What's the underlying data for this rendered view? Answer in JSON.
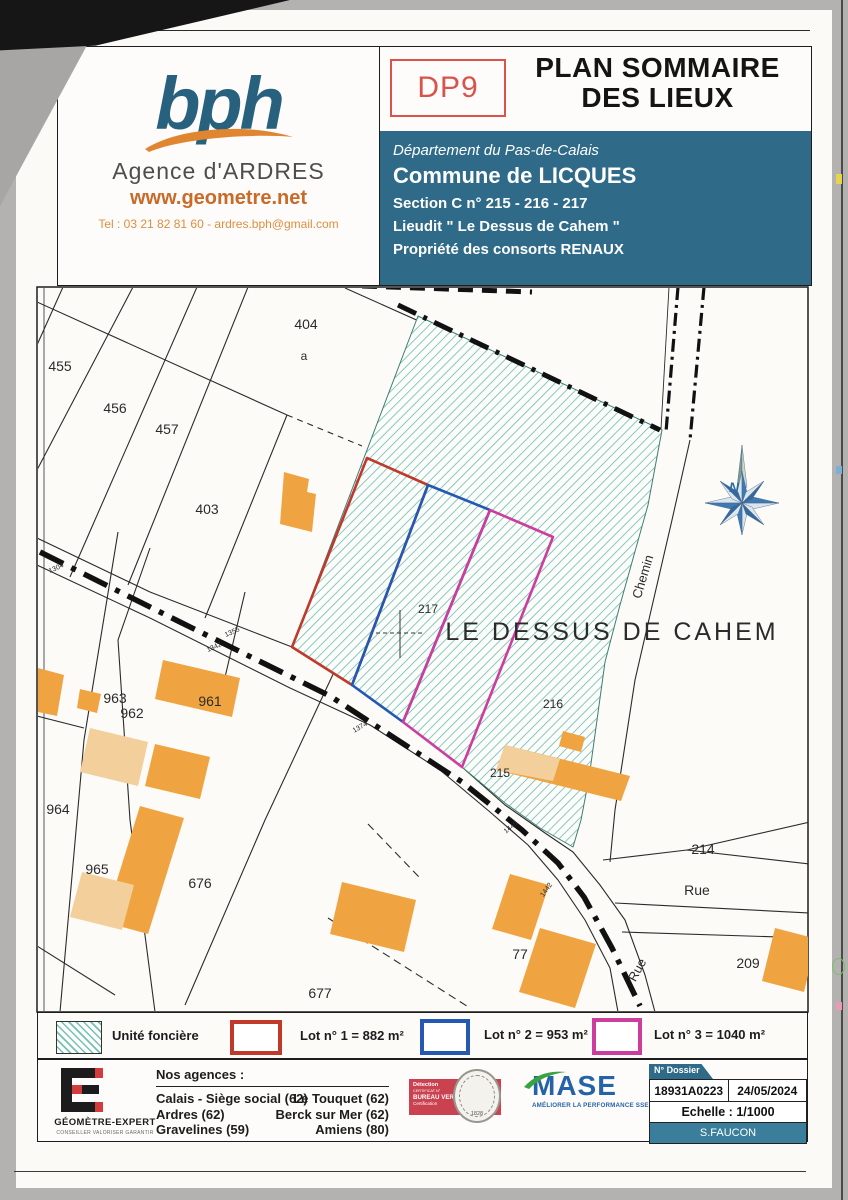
{
  "header": {
    "logo": {
      "brand": "bph",
      "agency": "Agence d'ARDRES",
      "website": "www.geometre.net",
      "contact": "Tel : 03 21 82 81 60 - ardres.bph@gmail.com"
    },
    "doc_code": "DP9",
    "title_line1": "PLAN SOMMAIRE",
    "title_line2": "DES LIEUX",
    "location": {
      "department": "Département du Pas-de-Calais",
      "commune": "Commune de LICQUES",
      "section": "Section C n° 215 - 216 - 217",
      "lieudit": "Lieudit \" Le Dessus de Cahem \"",
      "property": "Propriété des consorts RENAUX"
    }
  },
  "map": {
    "labels": [
      {
        "text": "455",
        "x": 60,
        "y": 371
      },
      {
        "text": "456",
        "x": 115,
        "y": 413
      },
      {
        "text": "457",
        "x": 167,
        "y": 434
      },
      {
        "text": "403",
        "x": 207,
        "y": 514
      },
      {
        "text": "404",
        "x": 306,
        "y": 329
      },
      {
        "text": "a",
        "x": 304,
        "y": 360,
        "s": 12
      },
      {
        "text": "963",
        "x": 115,
        "y": 703
      },
      {
        "text": "962",
        "x": 132,
        "y": 718
      },
      {
        "text": "961",
        "x": 210,
        "y": 706
      },
      {
        "text": "964",
        "x": 58,
        "y": 814
      },
      {
        "text": "965",
        "x": 97,
        "y": 874
      },
      {
        "text": "676",
        "x": 200,
        "y": 888
      },
      {
        "text": "677",
        "x": 320,
        "y": 998
      },
      {
        "text": "77",
        "x": 520,
        "y": 959
      },
      {
        "text": "209",
        "x": 748,
        "y": 968
      },
      {
        "text": "214",
        "x": 703,
        "y": 854
      },
      {
        "text": "215",
        "x": 500,
        "y": 777,
        "s": 12
      },
      {
        "text": "216",
        "x": 553,
        "y": 708,
        "s": 12
      },
      {
        "text": "217",
        "x": 428,
        "y": 613,
        "s": 12
      },
      {
        "text": "LE DESSUS DE CAHEM",
        "x": 612,
        "y": 640,
        "s": 25,
        "ls": 3
      },
      {
        "text": "Chemin",
        "x": 647,
        "y": 578,
        "s": 13,
        "r": -73
      },
      {
        "text": "Rue",
        "x": 697,
        "y": 895,
        "s": 14
      },
      {
        "text": "Rue",
        "x": 641,
        "y": 972,
        "s": 13,
        "r": -62
      },
      {
        "text": "1304",
        "x": 57,
        "y": 570,
        "s": 7,
        "r": -24
      },
      {
        "text": "1355",
        "x": 233,
        "y": 634,
        "s": 7,
        "r": -24
      },
      {
        "text": "1342",
        "x": 215,
        "y": 649,
        "s": 7,
        "r": -24
      },
      {
        "text": "1374",
        "x": 361,
        "y": 729,
        "s": 7,
        "r": -30
      },
      {
        "text": "1445",
        "x": 512,
        "y": 829,
        "s": 7,
        "r": -38
      },
      {
        "text": "1442",
        "x": 548,
        "y": 891,
        "s": 7,
        "r": -55
      },
      {
        "text": "N",
        "x": 734,
        "y": 492,
        "s": 14,
        "b": true,
        "i": true,
        "fill": "#2d6ca8"
      }
    ]
  },
  "legend": {
    "unite": {
      "label": "Unité foncière"
    },
    "lots": [
      {
        "label": "Lot n° 1 = 882 m²",
        "color": "#c0392b"
      },
      {
        "label": "Lot n° 2 = 953 m²",
        "color": "#2458b3"
      },
      {
        "label": "Lot n° 3 = 1040 m²",
        "color": "#cc3d9e"
      }
    ]
  },
  "footer": {
    "ge_logo": {
      "name": "GÉOMÈTRE-EXPERT",
      "tagline": "CONSEILLER VALORISER GARANTIR"
    },
    "agencies_title": "Nos agences :",
    "agencies_col1": [
      "Calais - Siège social (62)",
      "Ardres (62)",
      "Gravelines (59)"
    ],
    "agencies_col2": [
      "Le Touquet (62)",
      "Berck sur Mer (62)",
      "Amiens (80)"
    ],
    "certification": {
      "line1": "Détection",
      "line2": "CERTIFICAT N°",
      "line3": "BUREAU VERITAS",
      "line4": "Certification",
      "seal_year": "1828"
    },
    "mase": {
      "name": "MASE",
      "tagline": "AMÉLIORER LA PERFORMANCE SSE"
    },
    "dossier": {
      "header": "N° Dossier",
      "number": "18931A0223",
      "date": "24/05/2024",
      "scale": "Echelle : 1/1000",
      "author": "S.FAUCON"
    }
  },
  "colors": {
    "banner_blue": "#2f6b88",
    "dp9_red": "#d9534a",
    "lot1_red": "#c0392b",
    "lot2_blue": "#2458b3",
    "lot3_magenta": "#cc3d9e",
    "unite_hatch_teal": "#74c0b2",
    "building_orange": "#f0a441",
    "bph_teal": "#27617e",
    "bph_orange": "#e08530"
  }
}
